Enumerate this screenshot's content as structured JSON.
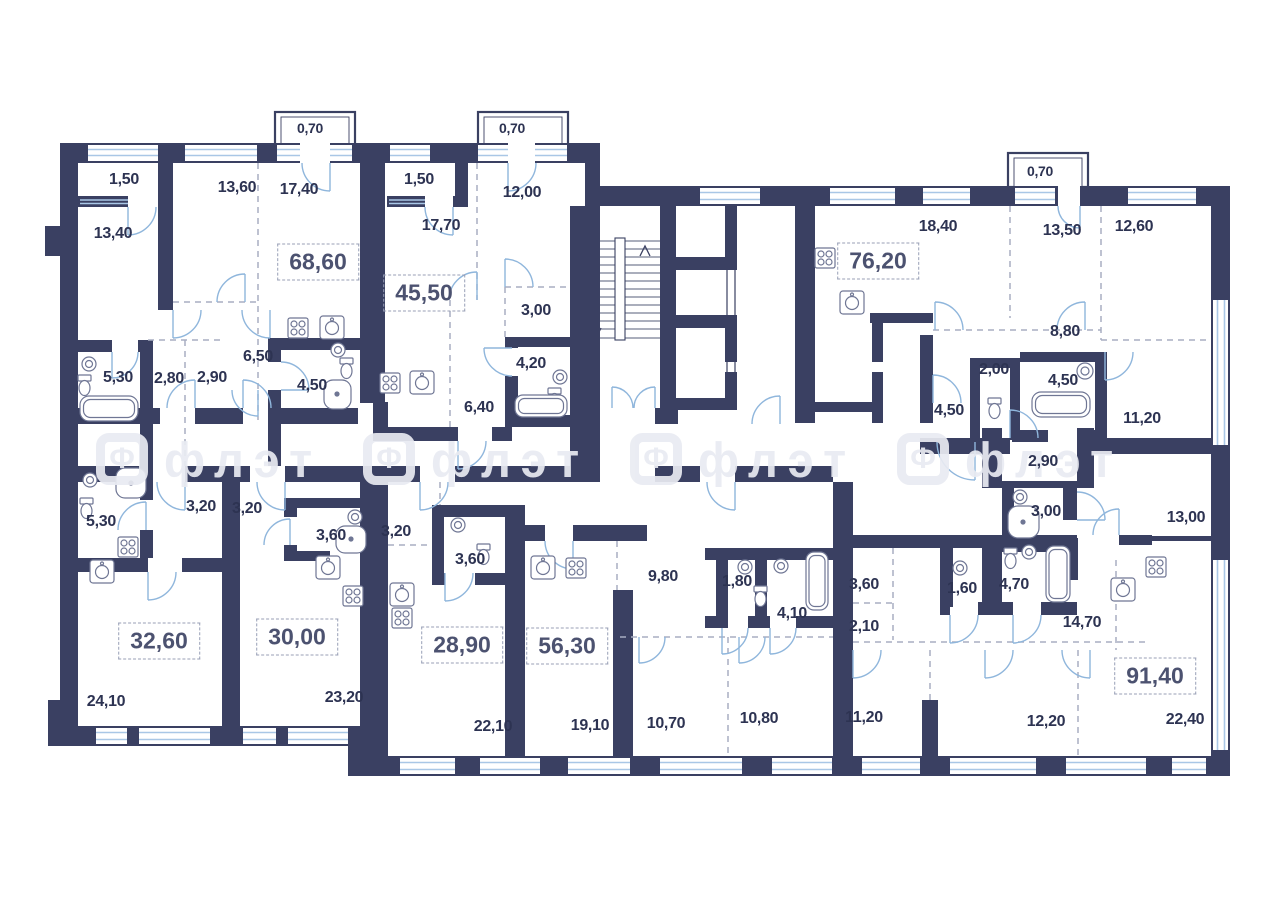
{
  "floor_plan": {
    "canvas": {
      "width": 1280,
      "height": 905
    },
    "colors": {
      "wall": "#3a4062",
      "room_text": "#2d3352",
      "area_text": "#4c5270",
      "window_glass": "#a9c7e6",
      "door_arc": "#8fb6dc",
      "dashed_partition": "#a8aec2",
      "fixture_stroke": "#6f7694",
      "watermark": "#e9ebf2",
      "background": "#ffffff"
    },
    "watermark": {
      "logo_letter": "Ф",
      "text": "флэт",
      "positions": [
        {
          "x": 96,
          "y": 433
        },
        {
          "x": 363,
          "y": 433
        },
        {
          "x": 630,
          "y": 433
        },
        {
          "x": 897,
          "y": 433
        }
      ]
    },
    "labels": {
      "apartment_areas": [
        {
          "text": "68,60",
          "x": 318,
          "y": 262
        },
        {
          "text": "45,50",
          "x": 424,
          "y": 293
        },
        {
          "text": "76,20",
          "x": 878,
          "y": 261
        },
        {
          "text": "32,60",
          "x": 159,
          "y": 641
        },
        {
          "text": "30,00",
          "x": 297,
          "y": 637
        },
        {
          "text": "28,90",
          "x": 462,
          "y": 645
        },
        {
          "text": "56,30",
          "x": 567,
          "y": 646
        },
        {
          "text": "91,40",
          "x": 1155,
          "y": 676
        }
      ],
      "balconies": [
        {
          "text": "0,70",
          "x": 310,
          "y": 128
        },
        {
          "text": "0,70",
          "x": 512,
          "y": 128
        },
        {
          "text": "0,70",
          "x": 1040,
          "y": 171
        }
      ],
      "rooms": [
        {
          "text": "1,50",
          "x": 124,
          "y": 180
        },
        {
          "text": "13,60",
          "x": 237,
          "y": 188
        },
        {
          "text": "17,40",
          "x": 299,
          "y": 190
        },
        {
          "text": "13,40",
          "x": 113,
          "y": 234
        },
        {
          "text": "1,50",
          "x": 419,
          "y": 180
        },
        {
          "text": "17,70",
          "x": 441,
          "y": 226
        },
        {
          "text": "12,00",
          "x": 522,
          "y": 193
        },
        {
          "text": "3,00",
          "x": 536,
          "y": 311
        },
        {
          "text": "4,20",
          "x": 531,
          "y": 364
        },
        {
          "text": "6,40",
          "x": 479,
          "y": 408
        },
        {
          "text": "6,50",
          "x": 258,
          "y": 357
        },
        {
          "text": "5,30",
          "x": 118,
          "y": 378
        },
        {
          "text": "2,80",
          "x": 169,
          "y": 379
        },
        {
          "text": "2,90",
          "x": 212,
          "y": 378
        },
        {
          "text": "4,50",
          "x": 312,
          "y": 386
        },
        {
          "text": "18,40",
          "x": 938,
          "y": 227
        },
        {
          "text": "13,50",
          "x": 1062,
          "y": 231
        },
        {
          "text": "12,60",
          "x": 1134,
          "y": 227
        },
        {
          "text": "8,80",
          "x": 1065,
          "y": 332
        },
        {
          "text": "2,00",
          "x": 994,
          "y": 370
        },
        {
          "text": "4,50",
          "x": 949,
          "y": 411
        },
        {
          "text": "4,50",
          "x": 1063,
          "y": 381
        },
        {
          "text": "11,20",
          "x": 1142,
          "y": 419
        },
        {
          "text": "2,90",
          "x": 1043,
          "y": 462
        },
        {
          "text": "3,00",
          "x": 1046,
          "y": 512
        },
        {
          "text": "13,00",
          "x": 1186,
          "y": 518
        },
        {
          "text": "5,30",
          "x": 101,
          "y": 522
        },
        {
          "text": "3,20",
          "x": 201,
          "y": 507
        },
        {
          "text": "3,20",
          "x": 247,
          "y": 509
        },
        {
          "text": "3,60",
          "x": 331,
          "y": 536
        },
        {
          "text": "3,20",
          "x": 396,
          "y": 532
        },
        {
          "text": "3,60",
          "x": 470,
          "y": 560
        },
        {
          "text": "24,10",
          "x": 106,
          "y": 702
        },
        {
          "text": "23,20",
          "x": 344,
          "y": 698
        },
        {
          "text": "22,10",
          "x": 493,
          "y": 727
        },
        {
          "text": "19,10",
          "x": 590,
          "y": 726
        },
        {
          "text": "9,80",
          "x": 663,
          "y": 577
        },
        {
          "text": "1,80",
          "x": 737,
          "y": 582
        },
        {
          "text": "4,10",
          "x": 792,
          "y": 614
        },
        {
          "text": "10,70",
          "x": 666,
          "y": 724
        },
        {
          "text": "10,80",
          "x": 759,
          "y": 719
        },
        {
          "text": "3,60",
          "x": 864,
          "y": 585
        },
        {
          "text": "2,10",
          "x": 864,
          "y": 627
        },
        {
          "text": "11,20",
          "x": 864,
          "y": 718
        },
        {
          "text": "1,60",
          "x": 962,
          "y": 589
        },
        {
          "text": "4,70",
          "x": 1014,
          "y": 585
        },
        {
          "text": "14,70",
          "x": 1082,
          "y": 623
        },
        {
          "text": "12,20",
          "x": 1046,
          "y": 722
        },
        {
          "text": "22,40",
          "x": 1185,
          "y": 720
        }
      ]
    }
  }
}
